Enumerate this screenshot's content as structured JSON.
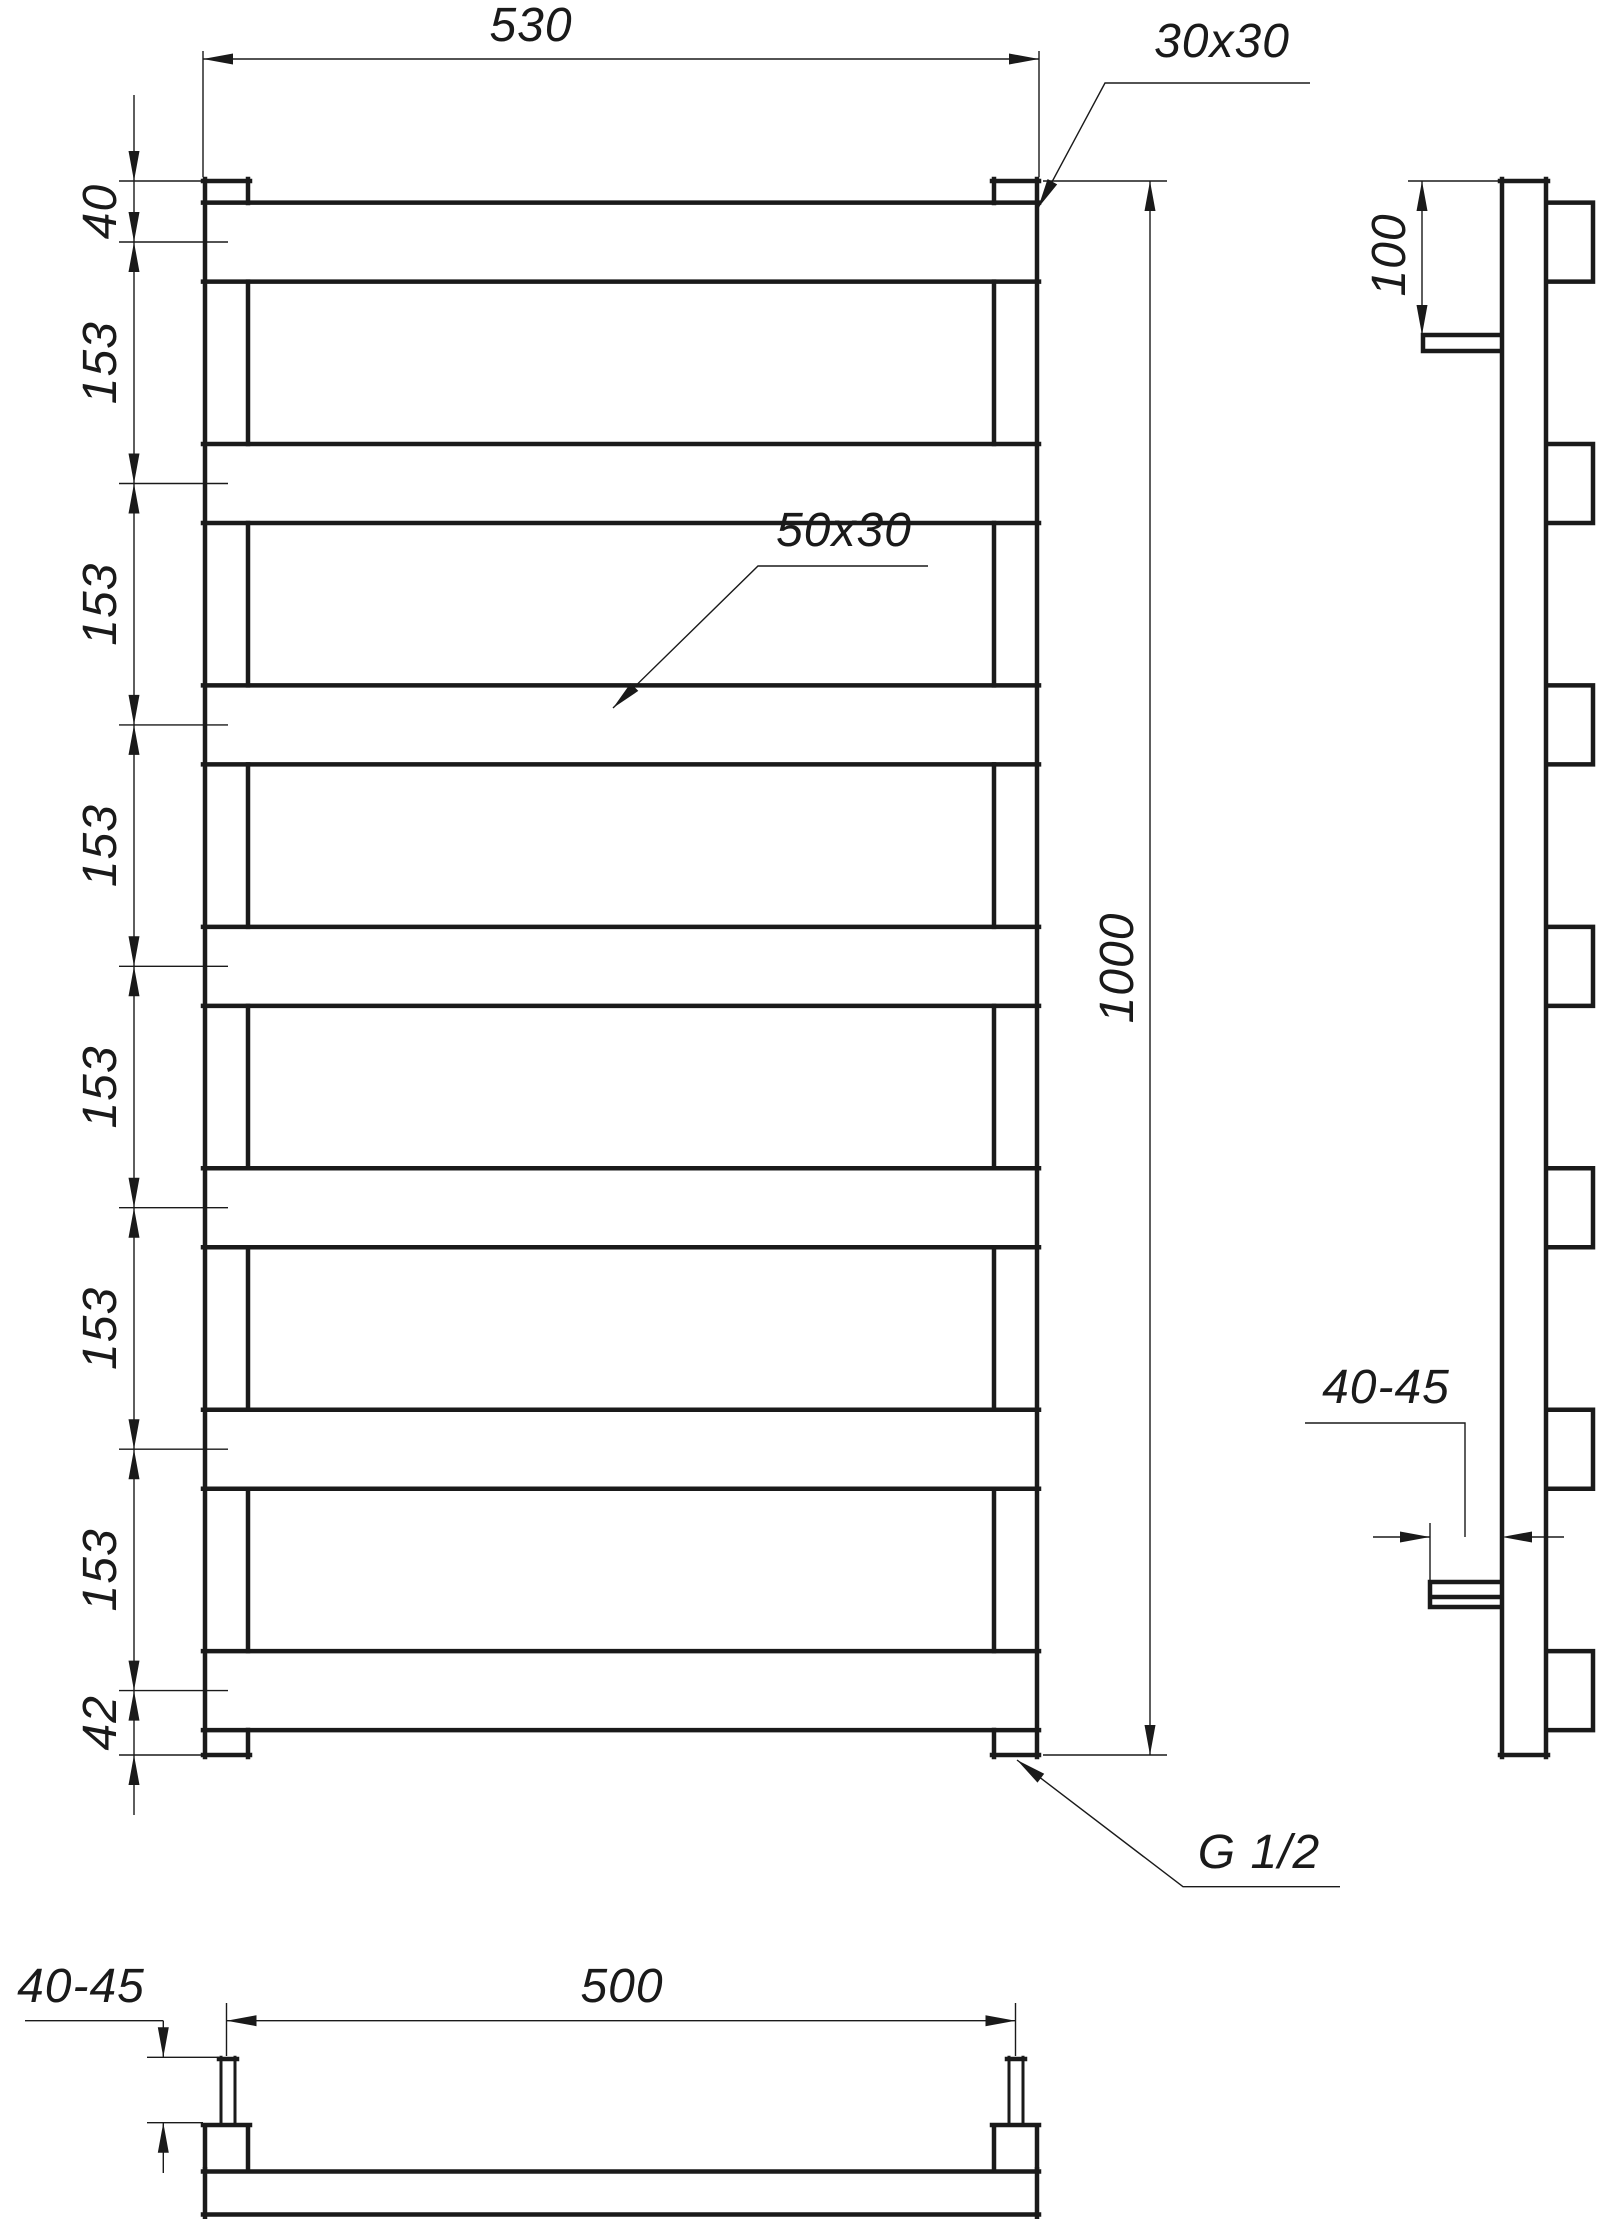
{
  "page": {
    "background": "#ffffff",
    "line_color": "#1a1a1a"
  },
  "front_view": {
    "overall_width_label": "530",
    "post_profile_label": "30x30",
    "rung_profile_label": "50x30",
    "overall_height_label": "1000",
    "top_spacing_label": "40",
    "rung_spacing_labels": [
      "153",
      "153",
      "153",
      "153",
      "153",
      "153"
    ],
    "bottom_spacing_label": "42",
    "thread_label": "G 1/2"
  },
  "side_view": {
    "bracket_offset_label": "100",
    "wall_distance_label": "40-45"
  },
  "bottom_view": {
    "connection_spacing_label": "500",
    "pipe_protrusion_label": "40-45"
  }
}
